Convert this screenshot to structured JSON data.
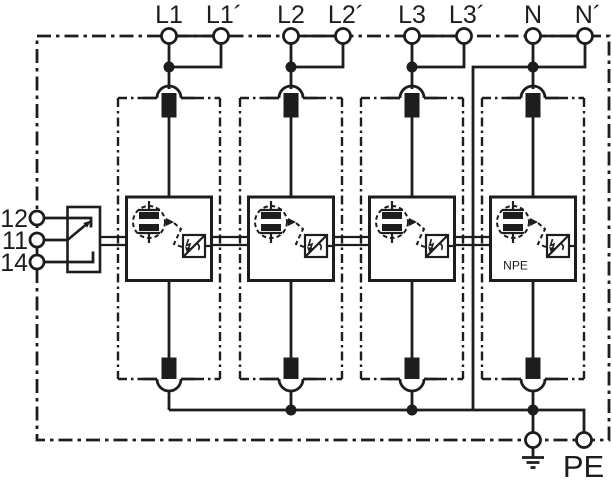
{
  "diagram": {
    "kind": "surge-arrester-wiring-diagram",
    "colors": {
      "background": "#ffffff",
      "line": "#1d1d1b"
    },
    "top_terminals": [
      {
        "label": "L1"
      },
      {
        "label": "L1´"
      },
      {
        "label": "L2"
      },
      {
        "label": "L2´"
      },
      {
        "label": "L3"
      },
      {
        "label": "L3´"
      },
      {
        "label": "N"
      },
      {
        "label": "N´"
      }
    ],
    "remote_contact_terminals": [
      {
        "label": "12"
      },
      {
        "label": "11"
      },
      {
        "label": "14"
      }
    ],
    "module_labels": {
      "npe": "NPE"
    },
    "bottom_terminals": {
      "pe": "PE"
    }
  }
}
